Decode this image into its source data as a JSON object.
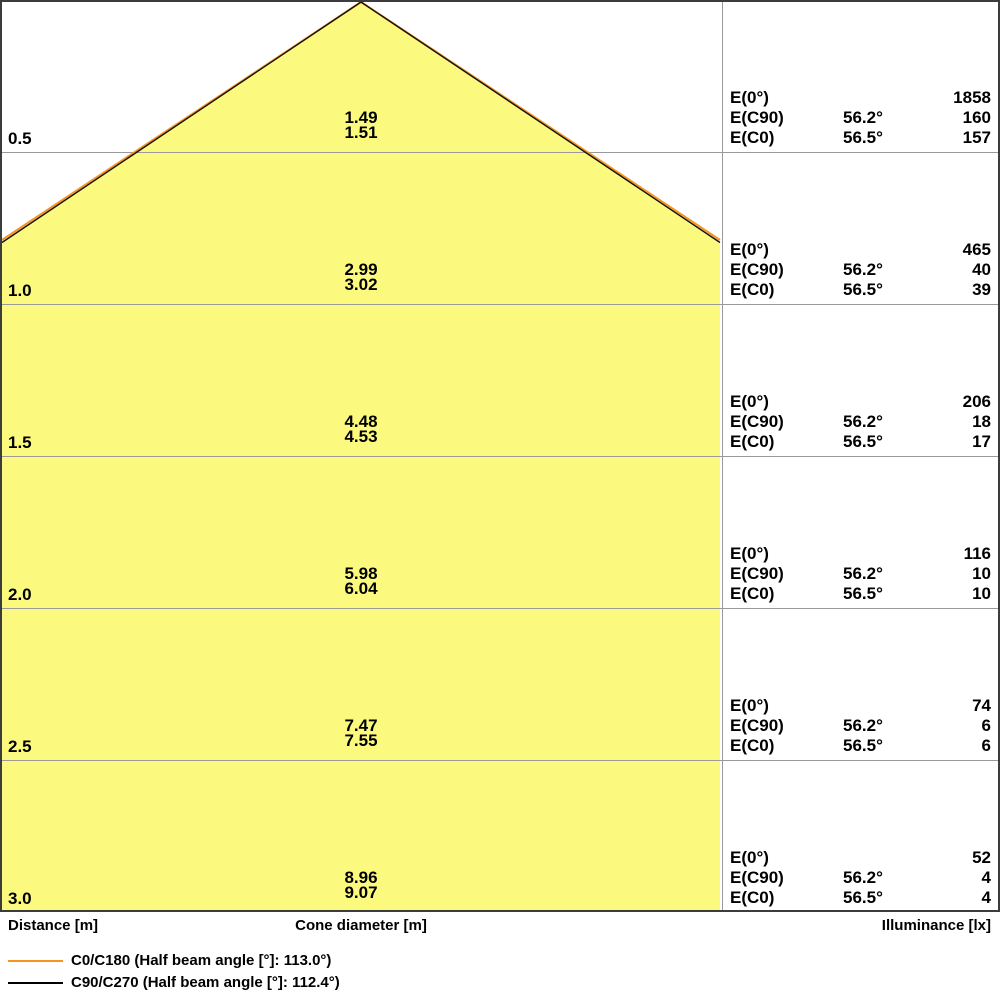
{
  "colors": {
    "cone_fill": "#FCFA7E",
    "c0_line": "#F7941E",
    "c90_line": "#111111",
    "grid_line": "#999999",
    "border": "#3C3C3C",
    "text": "#000000",
    "background": "#FFFFFF"
  },
  "axis": {
    "distance": "Distance [m]",
    "cone_diameter": "Cone diameter [m]",
    "illuminance": "Illuminance [lx]"
  },
  "legend": [
    {
      "label": "C0/C180 (Half beam angle [°]: 113.0°)"
    },
    {
      "label": "C90/C270 (Half beam angle [°]: 112.4°)"
    }
  ],
  "rows": [
    {
      "distance": "0.5",
      "dia_c90": "1.49",
      "dia_c0": "1.51",
      "e0_label": "E(0°)",
      "e0_value": "1858",
      "ec90_label": "E(C90)",
      "ec90_angle": "56.2°",
      "ec90_value": "160",
      "ec0_label": "E(C0)",
      "ec0_angle": "56.5°",
      "ec0_value": "157"
    },
    {
      "distance": "1.0",
      "dia_c90": "2.99",
      "dia_c0": "3.02",
      "e0_label": "E(0°)",
      "e0_value": "465",
      "ec90_label": "E(C90)",
      "ec90_angle": "56.2°",
      "ec90_value": "40",
      "ec0_label": "E(C0)",
      "ec0_angle": "56.5°",
      "ec0_value": "39"
    },
    {
      "distance": "1.5",
      "dia_c90": "4.48",
      "dia_c0": "4.53",
      "e0_label": "E(0°)",
      "e0_value": "206",
      "ec90_label": "E(C90)",
      "ec90_angle": "56.2°",
      "ec90_value": "18",
      "ec0_label": "E(C0)",
      "ec0_angle": "56.5°",
      "ec0_value": "17"
    },
    {
      "distance": "2.0",
      "dia_c90": "5.98",
      "dia_c0": "6.04",
      "e0_label": "E(0°)",
      "e0_value": "116",
      "ec90_label": "E(C90)",
      "ec90_angle": "56.2°",
      "ec90_value": "10",
      "ec0_label": "E(C0)",
      "ec0_angle": "56.5°",
      "ec0_value": "10"
    },
    {
      "distance": "2.5",
      "dia_c90": "7.47",
      "dia_c0": "7.55",
      "e0_label": "E(0°)",
      "e0_value": "74",
      "ec90_label": "E(C90)",
      "ec90_angle": "56.2°",
      "ec90_value": "6",
      "ec0_label": "E(C0)",
      "ec0_angle": "56.5°",
      "ec0_value": "6"
    },
    {
      "distance": "3.0",
      "dia_c90": "8.96",
      "dia_c0": "9.07",
      "e0_label": "E(0°)",
      "e0_value": "52",
      "ec90_label": "E(C90)",
      "ec90_angle": "56.2°",
      "ec90_value": "4",
      "ec0_label": "E(C0)",
      "ec0_angle": "56.5°",
      "ec0_value": "4"
    }
  ],
  "chart_data": {
    "type": "table",
    "description": "Light cone diagram: beam diameter and illuminance vs mounting distance",
    "half_beam_angle_c0_c180_deg": 113.0,
    "half_beam_angle_c90_c270_deg": 112.4,
    "columns": [
      "Distance [m]",
      "Cone diameter C90 [m]",
      "Cone diameter C0 [m]",
      "E(0°) [lx]",
      "E(C90) angle [°]",
      "E(C90) [lx]",
      "E(C0) angle [°]",
      "E(C0) [lx]"
    ],
    "rows": [
      [
        0.5,
        1.49,
        1.51,
        1858,
        56.2,
        160,
        56.5,
        157
      ],
      [
        1.0,
        2.99,
        3.02,
        465,
        56.2,
        40,
        56.5,
        39
      ],
      [
        1.5,
        4.48,
        4.53,
        206,
        56.2,
        18,
        56.5,
        17
      ],
      [
        2.0,
        5.98,
        6.04,
        116,
        56.2,
        10,
        56.5,
        10
      ],
      [
        2.5,
        7.47,
        7.55,
        74,
        56.2,
        6,
        56.5,
        6
      ],
      [
        3.0,
        8.96,
        9.07,
        52,
        56.2,
        4,
        56.5,
        4
      ]
    ]
  }
}
